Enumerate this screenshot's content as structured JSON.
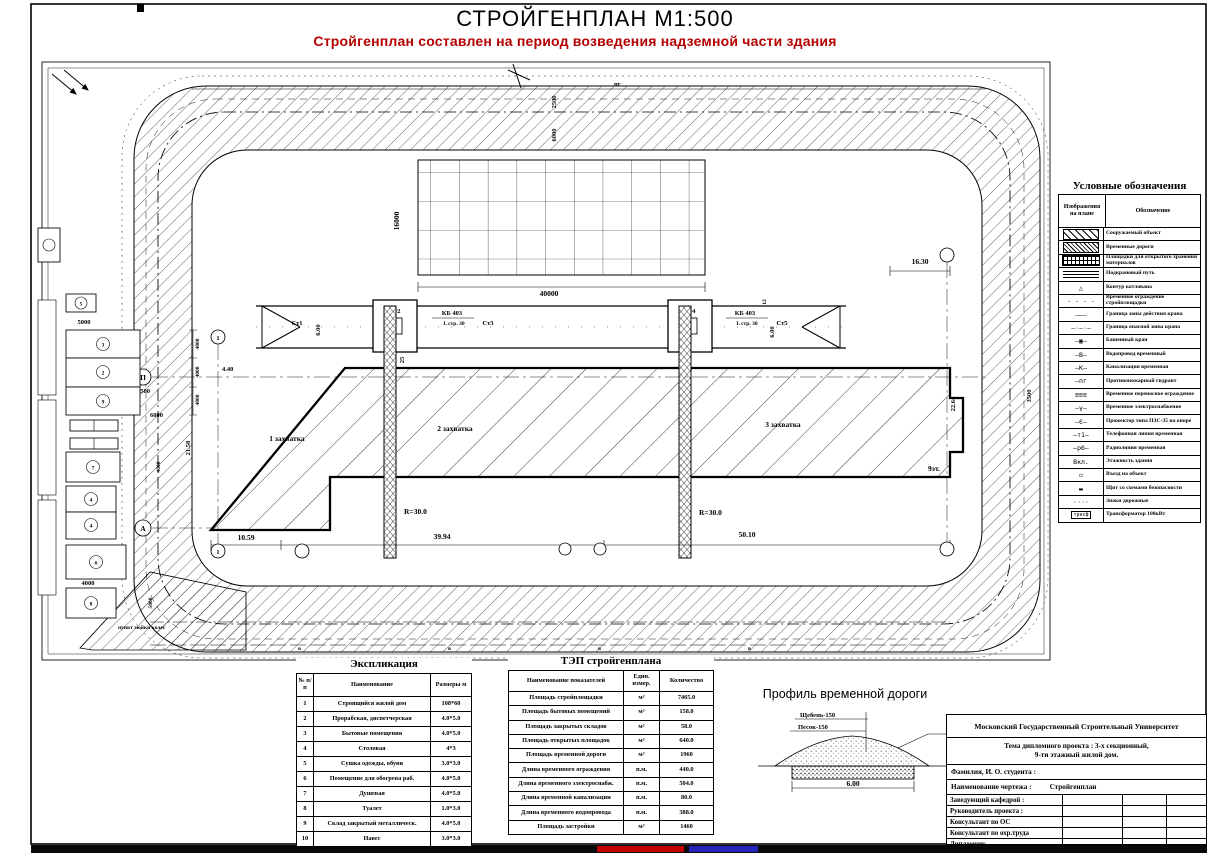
{
  "page": {
    "title": "СТРОЙГЕНПЛАН М1:500",
    "subtitle": "Стройгенплан составлен на период возведения надземной части здания",
    "subtitle_color": "#b40000"
  },
  "plan": {
    "labels": {
      "zone1": "1 захватка",
      "zone2": "2 захватка",
      "zone3": "3 захватка",
      "floors": "9эт.",
      "crane_type": "КБ 403",
      "crane_boom": "L стр. 30",
      "radius": "R=30.0",
      "st1": "Ст1",
      "st2": "Ст2",
      "st3": "Ст3",
      "st4": "Ст4",
      "st5": "Ст5",
      "wheel_wash": "пункт мойки колес",
      "hydrant": "пг",
      "axis_p": "П",
      "axis_a": "А",
      "axis_1": "1",
      "water": "в"
    },
    "dims": {
      "d40000": "40000",
      "d16000": "16000",
      "d2500": "2500",
      "d6000": "6000",
      "d5000": "5000",
      "d4000": "4000",
      "d16_30": "16.30",
      "d3500": "3500",
      "d22_64": "22.64",
      "d21_58": "21.58",
      "d4_40": "4.40",
      "d6_00": "6.00",
      "d12": "12",
      "d25": "25",
      "d10_59": "10.59",
      "d39_94": "39.94",
      "d50_10": "50.10"
    },
    "site_numbers": [
      "5",
      "3",
      "2",
      "9",
      "7",
      "4",
      "4",
      "6",
      "8"
    ]
  },
  "legend": {
    "title": "Условные обозначения",
    "col1": "Изображения на плане",
    "col2": "Обозначение",
    "items": [
      {
        "sym": "hatch-wide",
        "label": "Сооружаемый объект"
      },
      {
        "sym": "hatch-dense",
        "label": "Временные дороги"
      },
      {
        "sym": "grid",
        "label": "Площадки для открытого хранения материалов"
      },
      {
        "sym": "rails",
        "label": "Подкрановый путь"
      },
      {
        "sym": "glyph",
        "text": "△",
        "label": "Контур котлована"
      },
      {
        "sym": "glyph",
        "text": "- - - -",
        "label": "Временное ограждение стройплощадки"
      },
      {
        "sym": "glyph",
        "text": "———",
        "label": "Граница зоны действия крана"
      },
      {
        "sym": "glyph",
        "text": "—·—·—",
        "label": "Граница опасной зоны крана"
      },
      {
        "sym": "glyph",
        "text": "—▣—",
        "label": "Башенный кран"
      },
      {
        "sym": "glyph",
        "text": "—В—",
        "label": "Водопровод временный"
      },
      {
        "sym": "glyph",
        "text": "—К—",
        "label": "Канализация временная"
      },
      {
        "sym": "glyph",
        "text": "—пг",
        "label": "Противопожарный гидрант"
      },
      {
        "sym": "glyph",
        "text": "≡≡≡",
        "label": "Временное переносное ограждение"
      },
      {
        "sym": "glyph",
        "text": "—γ—",
        "label": "Временное электроснабжение"
      },
      {
        "sym": "glyph",
        "text": "—Є—",
        "label": "Прожектор типа ПЗС-35 на опоре"
      },
      {
        "sym": "glyph",
        "text": "—т1—",
        "label": "Телефонная линия временная"
      },
      {
        "sym": "glyph",
        "text": "—рб—",
        "label": "Радиолиния временная"
      },
      {
        "sym": "glyph",
        "text": "Вкл.",
        "label": "Этажность здания"
      },
      {
        "sym": "glyph",
        "text": "▭",
        "label": "Въезд на объект"
      },
      {
        "sym": "glyph",
        "text": "▬",
        "label": "Щит со схемами безопасности"
      },
      {
        "sym": "glyph",
        "text": "····",
        "label": "Знаки дорожные"
      },
      {
        "sym": "boxed",
        "text": "трнсф",
        "label": "Трансформатор 100кВт"
      }
    ]
  },
  "explication": {
    "title": "Экспликация",
    "headers": [
      "№ п/п",
      "Наименование",
      "Размеры м"
    ],
    "rows": [
      [
        "1",
        "Строящийся жилой дом",
        "108*60"
      ],
      [
        "2",
        "Прорабская, диспетчерская",
        "4.0*5.0"
      ],
      [
        "3",
        "Бытовые помещения",
        "4.0*5.0"
      ],
      [
        "4",
        "Столовая",
        "4*3"
      ],
      [
        "5",
        "Сушка одежды, обуви",
        "3.0*3.0"
      ],
      [
        "6",
        "Помещение для обогрева раб.",
        "4.0*5.0"
      ],
      [
        "7",
        "Душевая",
        "4.0*5.0"
      ],
      [
        "8",
        "Туалет",
        "1.0*3.0"
      ],
      [
        "9",
        "Склад закрытый металлическ.",
        "4.0*5.0"
      ],
      [
        "10",
        "Навес",
        "3.0*3.0"
      ]
    ]
  },
  "tep": {
    "title": "ТЭП стройгенплана",
    "headers": [
      "Наименование показателей",
      "Един. измер.",
      "Количество"
    ],
    "rows": [
      [
        "Площадь стройплощадки",
        "м²",
        "7465.0"
      ],
      [
        "Площадь бытовых помещений",
        "м²",
        "158.0"
      ],
      [
        "Площадь закрытых складов",
        "м²",
        "58.0"
      ],
      [
        "Площадь открытых площадок",
        "м²",
        "640.0"
      ],
      [
        "Площадь временной дороги",
        "м²",
        "1960"
      ],
      [
        "Длина временного ограждения",
        "п.м.",
        "440.0"
      ],
      [
        "Длина временного электроснабж.",
        "п.м.",
        "504.0"
      ],
      [
        "Длина временной канализации",
        "п.м.",
        "80.0"
      ],
      [
        "Длина временного водопровода",
        "п.м.",
        "388.0"
      ],
      [
        "Площадь застройки",
        "м²",
        "1460"
      ]
    ]
  },
  "road_profile": {
    "title": "Профиль временной дороги",
    "layer1": "Щебень-150",
    "layer2": "Песок-150",
    "width": "6.00"
  },
  "title_block": {
    "university": "Московский Государственный Строительный Университет",
    "theme1": "Тема дипломного проекта : 3-х секционный,",
    "theme2": "9-ти этажный жилой дом.",
    "student": "Фамилия, И. О. студента :",
    "drawing_label": "Наименование чертежа :",
    "drawing_name": "Стройгенплан",
    "rows": [
      "Заведующий кафедрой :",
      "Руководитель проекта :",
      "Консультант по ОС",
      "Консультант по охр.труда",
      "Дипломник"
    ]
  }
}
